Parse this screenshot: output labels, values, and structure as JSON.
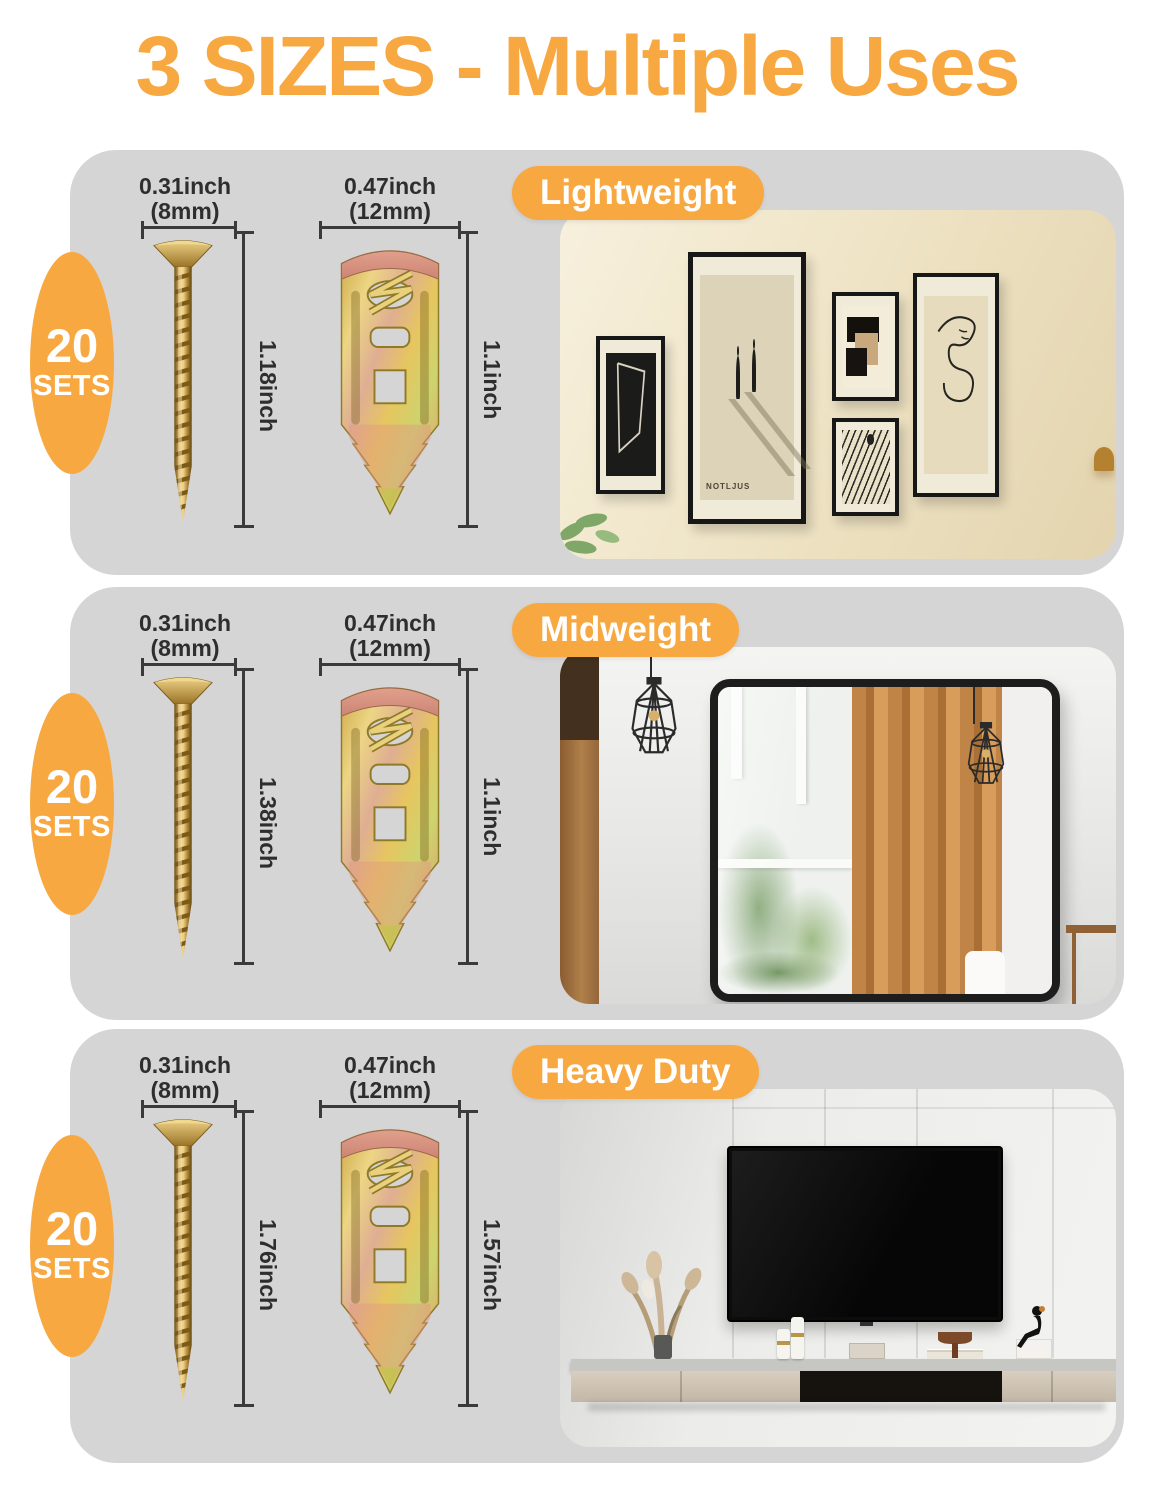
{
  "title": "3 SIZES - Multiple Uses",
  "colors": {
    "accent": "#F8A841",
    "section_background": "#D5D5D6",
    "dimension_ink": "#2e2e2e"
  },
  "sections": [
    {
      "tag": "Lightweight",
      "badge_count": "20",
      "badge_unit": "SETS",
      "screw": {
        "width": "0.31inch",
        "width_mm": "(8mm)",
        "length": "1.18inch"
      },
      "hanger": {
        "width": "0.47inch",
        "width_mm": "(12mm)",
        "length": "1.1inch"
      },
      "scene": {
        "type": "gallery-wall",
        "poster_text": "NOTLJUS"
      }
    },
    {
      "tag": "Midweight",
      "badge_count": "20",
      "badge_unit": "SETS",
      "screw": {
        "width": "0.31inch",
        "width_mm": "(8mm)",
        "length": "1.38inch"
      },
      "hanger": {
        "width": "0.47inch",
        "width_mm": "(12mm)",
        "length": "1.1inch"
      },
      "scene": {
        "type": "mirror-room"
      }
    },
    {
      "tag": "Heavy Duty",
      "badge_count": "20",
      "badge_unit": "SETS",
      "screw": {
        "width": "0.31inch",
        "width_mm": "(8mm)",
        "length": "1.76inch"
      },
      "hanger": {
        "width": "0.47inch",
        "width_mm": "(12mm)",
        "length": "1.57inch"
      },
      "scene": {
        "type": "tv-wall"
      }
    }
  ]
}
